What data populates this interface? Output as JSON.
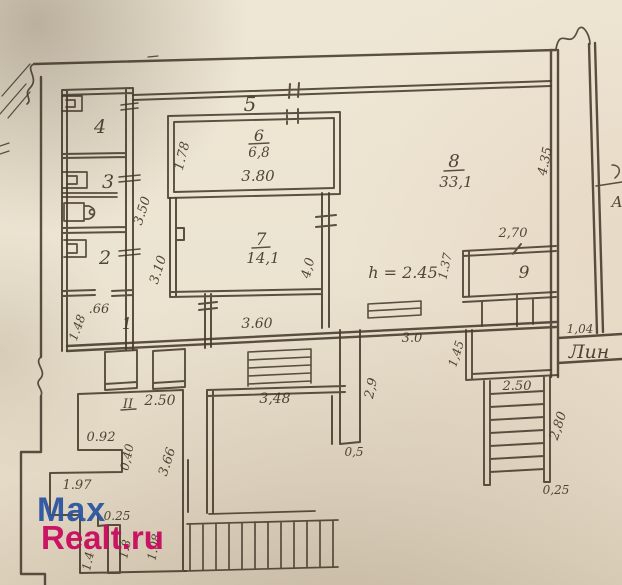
{
  "document_type": "scanned hand-drawn apartment floor plan (BTI technical passport drawing)",
  "colors": {
    "paper": "#ece3d0",
    "ink": "#453a2b",
    "watermark_blue": "#2d55a2",
    "watermark_magenta": "#c90b60"
  },
  "watermark": {
    "line1": "Max",
    "line2": "Realt.ru"
  },
  "rooms": {
    "n1": "1",
    "n2": "2",
    "n3": "3",
    "n4": "4",
    "n5": "5",
    "n6": "6",
    "area6": "6,8",
    "width6": "3.80",
    "n7": "7",
    "area7": "14,1",
    "n8": "8",
    "area8": "33,1",
    "n9": "9",
    "nII": "II",
    "dimII": "2.50"
  },
  "dims": {
    "w178": "1.78",
    "w350": "3.50",
    "w310": "3.10",
    "w066": ".66",
    "w148": "1.48",
    "w360": "3.60",
    "w40": "4,0",
    "w137": "1.37",
    "w270": "2,70",
    "w435": "4.35",
    "w104": "1,04",
    "w30": "3.0",
    "w145": "1,45",
    "w250s": "2.50",
    "w280": "2,80",
    "w025s": "0,25",
    "w29": "2,9",
    "w05": "0,5",
    "w348": "3,48",
    "w092": "0.92",
    "w040": "0,40",
    "w366": "3.66",
    "w197": "1.97",
    "w025l": "0.25",
    "w14": "1.4",
    "w18": "1.8",
    "w108": "1.08"
  },
  "notes": {
    "height": "h = 2.45",
    "street": "Лин",
    "edge_letter": "А"
  }
}
